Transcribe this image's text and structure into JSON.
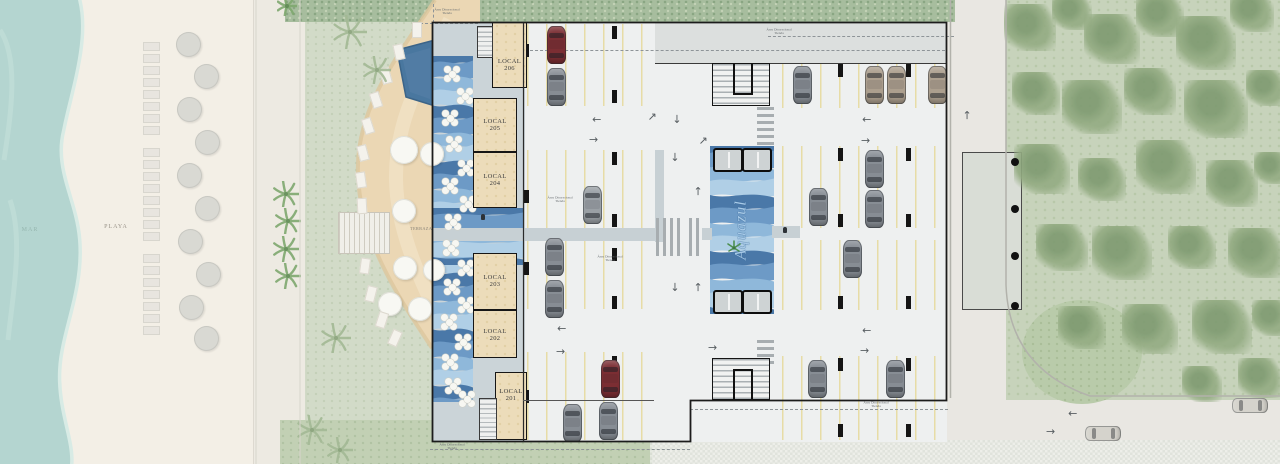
{
  "labels": {
    "mar": "MAR",
    "playa": "PLAYA",
    "terraza": "TERRAZA",
    "brand": "Aquazul",
    "annotation_line1": "Área Discrecional",
    "annotation_line2": "Tienda"
  },
  "locals": [
    {
      "name": "LOCAL",
      "number": "206"
    },
    {
      "name": "LOCAL",
      "number": "205"
    },
    {
      "name": "LOCAL",
      "number": "204"
    },
    {
      "name": "LOCAL",
      "number": "203"
    },
    {
      "name": "LOCAL",
      "number": "202"
    },
    {
      "name": "LOCAL",
      "number": "201"
    }
  ],
  "palette": {
    "sea": "#b4d5d0",
    "foam": "#d8ebe5",
    "sand": "#f3efe6",
    "sidewalk": "#edeae2",
    "lawn": "#cdd8c3",
    "hedge": "#a7bd9e",
    "deck": "#ebd7b4",
    "pool": "#49779f",
    "floor": "#eef0f0",
    "grayband": "#dcdfde",
    "walkway": "#c7d0d4",
    "circulation": "#cbd4d8",
    "stall": "#e7dca6",
    "column": "#151515",
    "dash": "#8e9498",
    "road": "#e9e7e2",
    "curb": "#b2b2ab",
    "forest": "#c7d3bb",
    "tree": "#94ac83",
    "treedark": "#7e9a70",
    "platform": "#d9ddd6",
    "hatch": "#e2e5df",
    "waves": [
      "#4a78a8",
      "#6d9ac6",
      "#8fb8da",
      "#b0cfe6"
    ],
    "car": {
      "gray": "#878d94",
      "gray2": "#9aa0a5",
      "red": "#7b2e33",
      "tan": "#ac9f8e",
      "faded": "#d5d3cc"
    }
  },
  "scene": {
    "cars": [
      {
        "x": 547,
        "y": 26,
        "o": "v",
        "c": "red"
      },
      {
        "x": 547,
        "y": 68,
        "o": "v",
        "c": "gray"
      },
      {
        "x": 583,
        "y": 186,
        "o": "v",
        "c": "gray2"
      },
      {
        "x": 545,
        "y": 238,
        "o": "v",
        "c": "gray"
      },
      {
        "x": 545,
        "y": 280,
        "o": "v",
        "c": "gray"
      },
      {
        "x": 601,
        "y": 360,
        "o": "v",
        "c": "red"
      },
      {
        "x": 599,
        "y": 402,
        "o": "v",
        "c": "gray"
      },
      {
        "x": 563,
        "y": 404,
        "o": "v",
        "c": "gray"
      },
      {
        "x": 793,
        "y": 66,
        "o": "v",
        "c": "gray"
      },
      {
        "x": 865,
        "y": 66,
        "o": "v",
        "c": "tan"
      },
      {
        "x": 887,
        "y": 66,
        "o": "v",
        "c": "tan"
      },
      {
        "x": 928,
        "y": 66,
        "o": "v",
        "c": "tan"
      },
      {
        "x": 865,
        "y": 150,
        "o": "v",
        "c": "gray"
      },
      {
        "x": 865,
        "y": 190,
        "o": "v",
        "c": "gray"
      },
      {
        "x": 809,
        "y": 188,
        "o": "v",
        "c": "gray"
      },
      {
        "x": 843,
        "y": 240,
        "o": "v",
        "c": "gray"
      },
      {
        "x": 886,
        "y": 360,
        "o": "v",
        "c": "gray"
      },
      {
        "x": 808,
        "y": 360,
        "o": "v",
        "c": "gray"
      },
      {
        "x": 1085,
        "y": 426,
        "o": "h",
        "c": "faded"
      },
      {
        "x": 1232,
        "y": 398,
        "o": "h",
        "c": "faded"
      }
    ],
    "stall_rows": [
      {
        "x": 527,
        "y": 24,
        "w": 127,
        "h": 82
      },
      {
        "x": 527,
        "y": 150,
        "w": 127,
        "h": 78
      },
      {
        "x": 527,
        "y": 241,
        "w": 127,
        "h": 68
      },
      {
        "x": 527,
        "y": 352,
        "w": 127,
        "h": 88
      },
      {
        "x": 782,
        "y": 64,
        "w": 163,
        "h": 44
      },
      {
        "x": 782,
        "y": 146,
        "w": 163,
        "h": 82
      },
      {
        "x": 782,
        "y": 240,
        "w": 163,
        "h": 70
      },
      {
        "x": 782,
        "y": 356,
        "w": 163,
        "h": 84
      }
    ],
    "ticks": [
      {
        "x": 524,
        "y": 44
      },
      {
        "x": 524,
        "y": 190
      },
      {
        "x": 524,
        "y": 262
      },
      {
        "x": 524,
        "y": 390
      },
      {
        "x": 612,
        "y": 26
      },
      {
        "x": 612,
        "y": 90
      },
      {
        "x": 612,
        "y": 152
      },
      {
        "x": 612,
        "y": 214
      },
      {
        "x": 612,
        "y": 248
      },
      {
        "x": 612,
        "y": 296
      },
      {
        "x": 612,
        "y": 356
      },
      {
        "x": 612,
        "y": 420
      },
      {
        "x": 838,
        "y": 64
      },
      {
        "x": 906,
        "y": 64
      },
      {
        "x": 838,
        "y": 148
      },
      {
        "x": 906,
        "y": 148
      },
      {
        "x": 838,
        "y": 214
      },
      {
        "x": 906,
        "y": 214
      },
      {
        "x": 838,
        "y": 296
      },
      {
        "x": 906,
        "y": 296
      },
      {
        "x": 838,
        "y": 358
      },
      {
        "x": 906,
        "y": 358
      },
      {
        "x": 838,
        "y": 424
      },
      {
        "x": 906,
        "y": 424
      }
    ],
    "arrows": [
      {
        "x": 592,
        "y": 114,
        "d": "l"
      },
      {
        "x": 589,
        "y": 135,
        "d": "r"
      },
      {
        "x": 648,
        "y": 112,
        "d": "ur"
      },
      {
        "x": 672,
        "y": 114,
        "d": "d"
      },
      {
        "x": 699,
        "y": 136,
        "d": "ur"
      },
      {
        "x": 557,
        "y": 323,
        "d": "l"
      },
      {
        "x": 556,
        "y": 347,
        "d": "r"
      },
      {
        "x": 862,
        "y": 114,
        "d": "l"
      },
      {
        "x": 861,
        "y": 136,
        "d": "r"
      },
      {
        "x": 862,
        "y": 325,
        "d": "l"
      },
      {
        "x": 860,
        "y": 346,
        "d": "r"
      },
      {
        "x": 670,
        "y": 152,
        "d": "d"
      },
      {
        "x": 694,
        "y": 186,
        "d": "u"
      },
      {
        "x": 670,
        "y": 282,
        "d": "d"
      },
      {
        "x": 694,
        "y": 282,
        "d": "u"
      },
      {
        "x": 708,
        "y": 343,
        "d": "r"
      },
      {
        "x": 963,
        "y": 110,
        "d": "u"
      },
      {
        "x": 1068,
        "y": 408,
        "d": "l"
      },
      {
        "x": 1046,
        "y": 427,
        "d": "r"
      }
    ],
    "zebras": [
      {
        "x": 757,
        "y": 107,
        "w": 17,
        "h": 42,
        "o": "h"
      },
      {
        "x": 757,
        "y": 340,
        "w": 17,
        "h": 24,
        "o": "h"
      },
      {
        "x": 656,
        "y": 218,
        "w": 27,
        "h": 38,
        "o": "v"
      },
      {
        "x": 689,
        "y": 218,
        "w": 13,
        "h": 38,
        "o": "v"
      }
    ],
    "walkways": [
      {
        "x": 433,
        "y": 228,
        "w": 223,
        "h": 13
      },
      {
        "x": 702,
        "y": 228,
        "w": 10,
        "h": 12
      },
      {
        "x": 772,
        "y": 226,
        "w": 28,
        "h": 12
      },
      {
        "x": 655,
        "y": 150,
        "w": 9,
        "h": 92
      }
    ],
    "dashes": [
      {
        "x": 530,
        "y": 50,
        "w": 415,
        "o": "h"
      },
      {
        "x": 690,
        "y": 409,
        "w": 258,
        "o": "h"
      },
      {
        "x": 430,
        "y": 449,
        "w": 260,
        "o": "h"
      },
      {
        "x": 768,
        "y": 36,
        "w": 186,
        "o": "h"
      },
      {
        "x": 415,
        "y": 23,
        "w": 63,
        "o": "h"
      },
      {
        "x": 433,
        "y": 4,
        "h": 19,
        "o": "v"
      }
    ],
    "annotations": [
      {
        "x": 447,
        "y": 8
      },
      {
        "x": 560,
        "y": 196
      },
      {
        "x": 610,
        "y": 255
      },
      {
        "x": 779,
        "y": 28
      },
      {
        "x": 876,
        "y": 401
      },
      {
        "x": 452,
        "y": 443
      }
    ],
    "elevators": [
      {
        "x": 713,
        "y": 148
      },
      {
        "x": 742,
        "y": 148
      },
      {
        "x": 713,
        "y": 290
      },
      {
        "x": 742,
        "y": 290
      }
    ],
    "wave_zones": [
      {
        "x": 432,
        "y": 56,
        "w": 41,
        "h": 346
      },
      {
        "x": 433,
        "y": 208,
        "w": 90,
        "h": 57
      },
      {
        "x": 710,
        "y": 146,
        "w": 64,
        "h": 168
      }
    ],
    "tables": [
      {
        "x": 444,
        "y": 66
      },
      {
        "x": 457,
        "y": 88
      },
      {
        "x": 442,
        "y": 110
      },
      {
        "x": 446,
        "y": 136
      },
      {
        "x": 458,
        "y": 160
      },
      {
        "x": 442,
        "y": 178
      },
      {
        "x": 460,
        "y": 196
      },
      {
        "x": 445,
        "y": 214
      },
      {
        "x": 443,
        "y": 240
      },
      {
        "x": 458,
        "y": 260
      },
      {
        "x": 444,
        "y": 279
      },
      {
        "x": 458,
        "y": 297
      },
      {
        "x": 441,
        "y": 314
      },
      {
        "x": 455,
        "y": 334
      },
      {
        "x": 442,
        "y": 354
      },
      {
        "x": 445,
        "y": 378
      },
      {
        "x": 459,
        "y": 391
      }
    ],
    "beach_chairs": [
      {
        "x": 143,
        "y": 42
      },
      {
        "x": 143,
        "y": 54
      },
      {
        "x": 143,
        "y": 66
      },
      {
        "x": 143,
        "y": 78
      },
      {
        "x": 143,
        "y": 90
      },
      {
        "x": 143,
        "y": 102
      },
      {
        "x": 143,
        "y": 114
      },
      {
        "x": 143,
        "y": 126
      },
      {
        "x": 143,
        "y": 148
      },
      {
        "x": 143,
        "y": 160
      },
      {
        "x": 143,
        "y": 172
      },
      {
        "x": 143,
        "y": 184
      },
      {
        "x": 143,
        "y": 196
      },
      {
        "x": 143,
        "y": 208
      },
      {
        "x": 143,
        "y": 220
      },
      {
        "x": 143,
        "y": 232
      },
      {
        "x": 143,
        "y": 254
      },
      {
        "x": 143,
        "y": 266
      },
      {
        "x": 143,
        "y": 278
      },
      {
        "x": 143,
        "y": 290
      },
      {
        "x": 143,
        "y": 302
      },
      {
        "x": 143,
        "y": 314
      },
      {
        "x": 143,
        "y": 326
      }
    ],
    "beach_umbrellas": [
      {
        "x": 176,
        "y": 32
      },
      {
        "x": 194,
        "y": 64
      },
      {
        "x": 177,
        "y": 97
      },
      {
        "x": 195,
        "y": 130
      },
      {
        "x": 177,
        "y": 163
      },
      {
        "x": 195,
        "y": 196
      },
      {
        "x": 178,
        "y": 229
      },
      {
        "x": 196,
        "y": 262
      },
      {
        "x": 179,
        "y": 295
      },
      {
        "x": 194,
        "y": 326
      }
    ],
    "pool_umbrellas": [
      {
        "x": 390,
        "y": 136,
        "r": 14
      },
      {
        "x": 420,
        "y": 142,
        "r": 12
      },
      {
        "x": 392,
        "y": 199,
        "r": 12
      },
      {
        "x": 393,
        "y": 256,
        "r": 12
      },
      {
        "x": 423,
        "y": 259,
        "r": 11
      },
      {
        "x": 378,
        "y": 292,
        "r": 12
      },
      {
        "x": 408,
        "y": 297,
        "r": 12
      }
    ],
    "loungers": [
      {
        "x": 412,
        "y": 22,
        "a": 0
      },
      {
        "x": 394,
        "y": 44,
        "a": -12
      },
      {
        "x": 381,
        "y": 68,
        "a": -15
      },
      {
        "x": 371,
        "y": 92,
        "a": -18
      },
      {
        "x": 363,
        "y": 118,
        "a": -18
      },
      {
        "x": 358,
        "y": 145,
        "a": -15
      },
      {
        "x": 356,
        "y": 172,
        "a": -8
      },
      {
        "x": 357,
        "y": 198,
        "a": -3
      },
      {
        "x": 360,
        "y": 258,
        "a": 8
      },
      {
        "x": 366,
        "y": 286,
        "a": 14
      },
      {
        "x": 377,
        "y": 312,
        "a": 18
      },
      {
        "x": 390,
        "y": 330,
        "a": 24
      }
    ],
    "palms": [
      {
        "x": 350,
        "y": 32,
        "s": 17,
        "t": "soft"
      },
      {
        "x": 377,
        "y": 70,
        "s": 14,
        "t": "soft"
      },
      {
        "x": 336,
        "y": 338,
        "s": 15,
        "t": "soft"
      },
      {
        "x": 312,
        "y": 430,
        "s": 15,
        "t": "soft"
      },
      {
        "x": 340,
        "y": 450,
        "s": 13,
        "t": "soft"
      },
      {
        "x": 286,
        "y": 194,
        "s": 13,
        "t": "bright"
      },
      {
        "x": 288,
        "y": 221,
        "s": 13,
        "t": "bright"
      },
      {
        "x": 286,
        "y": 249,
        "s": 13,
        "t": "bright"
      },
      {
        "x": 288,
        "y": 276,
        "s": 13,
        "t": "bright"
      },
      {
        "x": 287,
        "y": 6,
        "s": 10,
        "t": "bright"
      }
    ],
    "trees": [
      {
        "x": 1030,
        "y": 30,
        "r": 26
      },
      {
        "x": 1072,
        "y": 14,
        "r": 20
      },
      {
        "x": 1112,
        "y": 42,
        "r": 28
      },
      {
        "x": 1160,
        "y": 18,
        "r": 24
      },
      {
        "x": 1206,
        "y": 46,
        "r": 30
      },
      {
        "x": 1252,
        "y": 14,
        "r": 22
      },
      {
        "x": 1036,
        "y": 96,
        "r": 24
      },
      {
        "x": 1092,
        "y": 110,
        "r": 30
      },
      {
        "x": 1150,
        "y": 94,
        "r": 26
      },
      {
        "x": 1216,
        "y": 112,
        "r": 32
      },
      {
        "x": 1266,
        "y": 90,
        "r": 20
      },
      {
        "x": 1042,
        "y": 172,
        "r": 28
      },
      {
        "x": 1102,
        "y": 182,
        "r": 24
      },
      {
        "x": 1166,
        "y": 170,
        "r": 30
      },
      {
        "x": 1232,
        "y": 186,
        "r": 26
      },
      {
        "x": 1272,
        "y": 170,
        "r": 18
      },
      {
        "x": 1062,
        "y": 250,
        "r": 26
      },
      {
        "x": 1122,
        "y": 256,
        "r": 30
      },
      {
        "x": 1192,
        "y": 250,
        "r": 24
      },
      {
        "x": 1256,
        "y": 256,
        "r": 28
      },
      {
        "x": 1082,
        "y": 330,
        "r": 24
      },
      {
        "x": 1150,
        "y": 332,
        "r": 28
      },
      {
        "x": 1222,
        "y": 330,
        "r": 30
      },
      {
        "x": 1272,
        "y": 320,
        "r": 20
      },
      {
        "x": 1202,
        "y": 386,
        "r": 20
      },
      {
        "x": 1260,
        "y": 380,
        "r": 22
      }
    ],
    "platform_dots": [
      {
        "x": 1011,
        "y": 158
      },
      {
        "x": 1011,
        "y": 205
      },
      {
        "x": 1011,
        "y": 252
      },
      {
        "x": 1011,
        "y": 302
      }
    ],
    "persons": [
      {
        "x": 783,
        "y": 227
      },
      {
        "x": 481,
        "y": 214
      }
    ]
  }
}
